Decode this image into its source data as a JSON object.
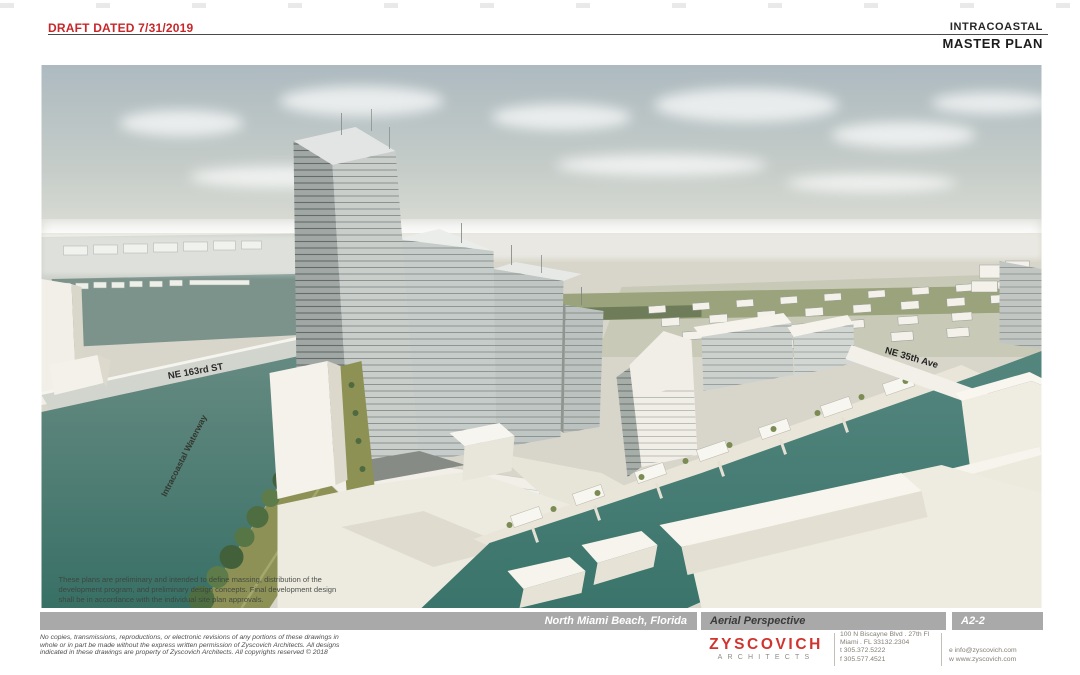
{
  "header": {
    "draft_label": "DRAFT DATED 7/31/2019",
    "project_line1": "INTRACOASTAL",
    "project_line2": "MASTER PLAN"
  },
  "rendering": {
    "street_ne163": "NE 163rd ST",
    "waterway": "Intracoastal Waterway",
    "street_ne35": "NE 35th Ave",
    "note1": "These plans are preliminary and intended to define massing, distribution of the",
    "note2": "development program, and preliminary design concepts. Final development design",
    "note3": "shall be in accordance with the individual site plan approvals."
  },
  "titleblock": {
    "location": "North Miami Beach, Florida",
    "sheet_title": "Aerial Perspective",
    "sheet_number": "A2-2"
  },
  "firm": {
    "name": "ZYSCOVICH",
    "tagline": "ARCHITECTS",
    "addr1": "100 N Biscayne Blvd . 27th Fl",
    "addr2": "Miami . FL  33132.2304",
    "tel": "t   305.372.5222",
    "fax": "f   305.577.4521",
    "email": "e   info@zyscovich.com",
    "web": "w   www.zyscovich.com"
  },
  "copyright": {
    "l1": "No copies, transmissions, reproductions, or electronic revisions of any portions of these drawings in",
    "l2": "whole or in part be made without the express written permission of Zyscovich Architects. All designs",
    "l3": "indicated in these drawings are property of Zyscovich Architects. All copyrights reserved © 2018"
  },
  "colors": {
    "draft_red": "#C8272A",
    "logo_red": "#D0342F",
    "bar_gray": "#A9A9A9",
    "water_teal": "#3F7A72",
    "olive_green": "#8D9254"
  }
}
